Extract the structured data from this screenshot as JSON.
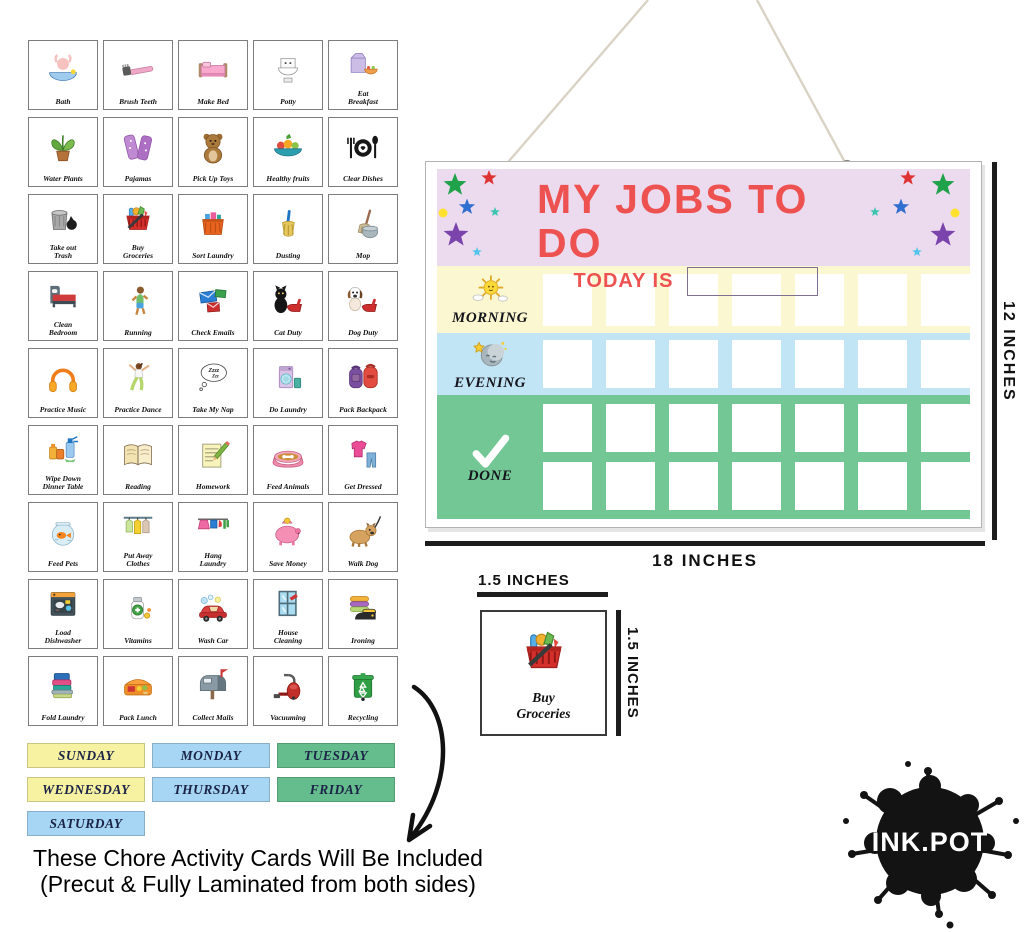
{
  "board": {
    "title": "MY JOBS TO DO",
    "today_label": "TODAY IS",
    "columns": 7,
    "rows": [
      {
        "key": "morning",
        "label": "MORNING",
        "icon": "sun-clouds",
        "square_rows": 1,
        "square_h": 52
      },
      {
        "key": "evening",
        "label": "EVENING",
        "icon": "moon-stars",
        "square_rows": 1,
        "square_h": 48
      },
      {
        "key": "done",
        "label": "DONE",
        "icon": "check",
        "square_rows": 2,
        "square_h": 48
      }
    ]
  },
  "dimensions": {
    "board_height": "12 INCHES",
    "board_width": "18 INCHES",
    "card_width": "1.5 INCHES",
    "card_height": "1.5 INCHES"
  },
  "chore_cards": [
    {
      "label": "Bath",
      "icon": "bath"
    },
    {
      "label": "Brush Teeth",
      "icon": "brush-teeth"
    },
    {
      "label": "Make Bed",
      "icon": "make-bed"
    },
    {
      "label": "Potty",
      "icon": "potty"
    },
    {
      "label": "Eat\nBreakfast",
      "icon": "eat-breakfast"
    },
    {
      "label": "Water Plants",
      "icon": "water-plants"
    },
    {
      "label": "Pajamas",
      "icon": "pajamas"
    },
    {
      "label": "Pick Up Toys",
      "icon": "pick-up-toys"
    },
    {
      "label": "Healthy fruits",
      "icon": "healthy-fruits"
    },
    {
      "label": "Clear Dishes",
      "icon": "clear-dishes"
    },
    {
      "label": "Take out\nTrash",
      "icon": "take-out-trash"
    },
    {
      "label": "Buy\nGroceries",
      "icon": "buy-groceries"
    },
    {
      "label": "Sort Laundry",
      "icon": "sort-laundry"
    },
    {
      "label": "Dusting",
      "icon": "dusting"
    },
    {
      "label": "Mop",
      "icon": "mop"
    },
    {
      "label": "Clean\nBedroom",
      "icon": "clean-bedroom"
    },
    {
      "label": "Running",
      "icon": "running"
    },
    {
      "label": "Check Emails",
      "icon": "check-emails"
    },
    {
      "label": "Cat Duty",
      "icon": "cat-duty"
    },
    {
      "label": "Dog Duty",
      "icon": "dog-duty"
    },
    {
      "label": "Practice Music",
      "icon": "practice-music"
    },
    {
      "label": "Practice Dance",
      "icon": "practice-dance"
    },
    {
      "label": "Take My Nap",
      "icon": "take-my-nap"
    },
    {
      "label": "Do Laundry",
      "icon": "do-laundry"
    },
    {
      "label": "Pack Backpack",
      "icon": "pack-backpack"
    },
    {
      "label": "Wipe Down\nDinner Table",
      "icon": "wipe-down-table"
    },
    {
      "label": "Reading",
      "icon": "reading"
    },
    {
      "label": "Homework",
      "icon": "homework"
    },
    {
      "label": "Feed Animals",
      "icon": "feed-animals"
    },
    {
      "label": "Get Dressed",
      "icon": "get-dressed"
    },
    {
      "label": "Feed Pets",
      "icon": "feed-pets"
    },
    {
      "label": "Put Away\nClothes",
      "icon": "put-away-clothes"
    },
    {
      "label": "Hang\nLaundry",
      "icon": "hang-laundry"
    },
    {
      "label": "Save Money",
      "icon": "save-money"
    },
    {
      "label": "Walk Dog",
      "icon": "walk-dog"
    },
    {
      "label": "Load\nDishwasher",
      "icon": "load-dishwasher"
    },
    {
      "label": "Vitamins",
      "icon": "vitamins"
    },
    {
      "label": "Wash Car",
      "icon": "wash-car"
    },
    {
      "label": "House\nCleaning",
      "icon": "house-cleaning"
    },
    {
      "label": "Ironing",
      "icon": "ironing"
    },
    {
      "label": "Fold Laundry",
      "icon": "fold-laundry"
    },
    {
      "label": "Pack Lunch",
      "icon": "pack-lunch"
    },
    {
      "label": "Collect Mails",
      "icon": "collect-mails"
    },
    {
      "label": "Vacuuming",
      "icon": "vacuuming"
    },
    {
      "label": "Recycling",
      "icon": "recycling"
    }
  ],
  "day_cards": [
    {
      "label": "SUNDAY",
      "color": "yellow"
    },
    {
      "label": "MONDAY",
      "color": "blue"
    },
    {
      "label": "TUESDAY",
      "color": "green"
    },
    {
      "label": "WEDNESDAY",
      "color": "yellow"
    },
    {
      "label": "THURSDAY",
      "color": "blue"
    },
    {
      "label": "FRIDAY",
      "color": "green"
    },
    {
      "label": "SATURDAY",
      "color": "blue"
    }
  ],
  "sample_card": {
    "label": "Buy\nGroceries",
    "icon": "buy-groceries"
  },
  "note": {
    "line1": "These Chore Activity Cards Will Be Included",
    "line2": "(Precut & Fully Laminated from both sides)"
  },
  "logo": {
    "text": "INK.POT"
  },
  "colors": {
    "header_bg": "#ecdaee",
    "morning_bg": "#fbf7d0",
    "evening_bg": "#c2e5f6",
    "done_bg": "#72c795",
    "title_red": "#ed5150",
    "day_yellow": "#f6f2a2",
    "day_blue": "#a6d6f3",
    "day_green": "#65bd8d"
  },
  "decor": {
    "left_stars": [
      {
        "type": "star",
        "x": 18,
        "y": 16,
        "r": 12,
        "color": "#1fa24a"
      },
      {
        "type": "star",
        "x": 52,
        "y": 9,
        "r": 8,
        "color": "#df3333"
      },
      {
        "type": "dot",
        "x": 6,
        "y": 44,
        "r": 4.5,
        "color": "#ffe230"
      },
      {
        "type": "star",
        "x": 30,
        "y": 38,
        "r": 8.5,
        "color": "#2f6fd0"
      },
      {
        "type": "star",
        "x": 58,
        "y": 43,
        "r": 5,
        "color": "#3bc4b0"
      },
      {
        "type": "star",
        "x": 19,
        "y": 66,
        "r": 13,
        "color": "#7b44ad"
      },
      {
        "type": "star",
        "x": 40,
        "y": 83,
        "r": 5,
        "color": "#52c5e8"
      }
    ],
    "right_stars": [
      {
        "type": "star",
        "x": 53,
        "y": 9,
        "r": 8,
        "color": "#df3333"
      },
      {
        "type": "star",
        "x": 88,
        "y": 16,
        "r": 12,
        "color": "#1fa24a"
      },
      {
        "type": "star",
        "x": 46,
        "y": 38,
        "r": 8.5,
        "color": "#2f6fd0"
      },
      {
        "type": "star",
        "x": 20,
        "y": 43,
        "r": 5,
        "color": "#3bc4b0"
      },
      {
        "type": "dot",
        "x": 100,
        "y": 44,
        "r": 4.5,
        "color": "#ffe230"
      },
      {
        "type": "star",
        "x": 88,
        "y": 66,
        "r": 13,
        "color": "#7b44ad"
      },
      {
        "type": "star",
        "x": 62,
        "y": 83,
        "r": 5,
        "color": "#52c5e8"
      }
    ]
  }
}
